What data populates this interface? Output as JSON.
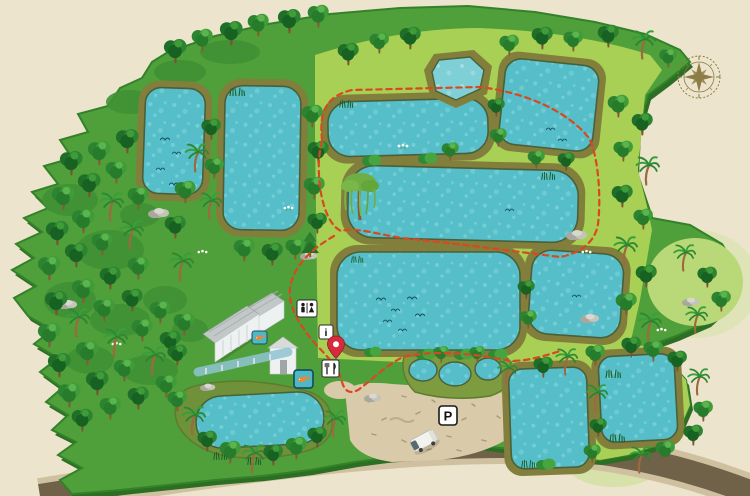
{
  "map": {
    "type": "illustrated-park-map",
    "description": "fishing lakes park map",
    "colors": {
      "background": "#ece4cc",
      "land": "#4f9f3a",
      "land_edge": "#2c6e23",
      "meadow": "#a8d055",
      "water": "#55bec9",
      "water_light": "#7fd0d6",
      "bank": "#827e3c",
      "road": "#6f6249",
      "gravel": "#d9cbaa",
      "trail": "#d9481f",
      "pin_red": "#d62b3c",
      "fish_icon_bg": "#4fb8c6",
      "fish_icon_fish": "#e8883b",
      "compass": "#8a7a45"
    }
  },
  "markers": {
    "parking": {
      "label": "P"
    },
    "info": {
      "label": "i"
    },
    "toilets": {
      "icon": "toilets-icon"
    },
    "restaurant": {
      "icon": "restaurant-icon"
    },
    "fish_shop_small": {
      "icon": "fish-icon"
    },
    "fish_shop_large": {
      "icon": "fish-icon"
    },
    "location_pin": {
      "icon": "location-pin-icon"
    }
  },
  "trail": {
    "style": "dashed",
    "color": "#d9481f"
  },
  "vehicle": {
    "icon": "van-icon"
  },
  "compass": {
    "icon": "compass-rose-icon"
  }
}
